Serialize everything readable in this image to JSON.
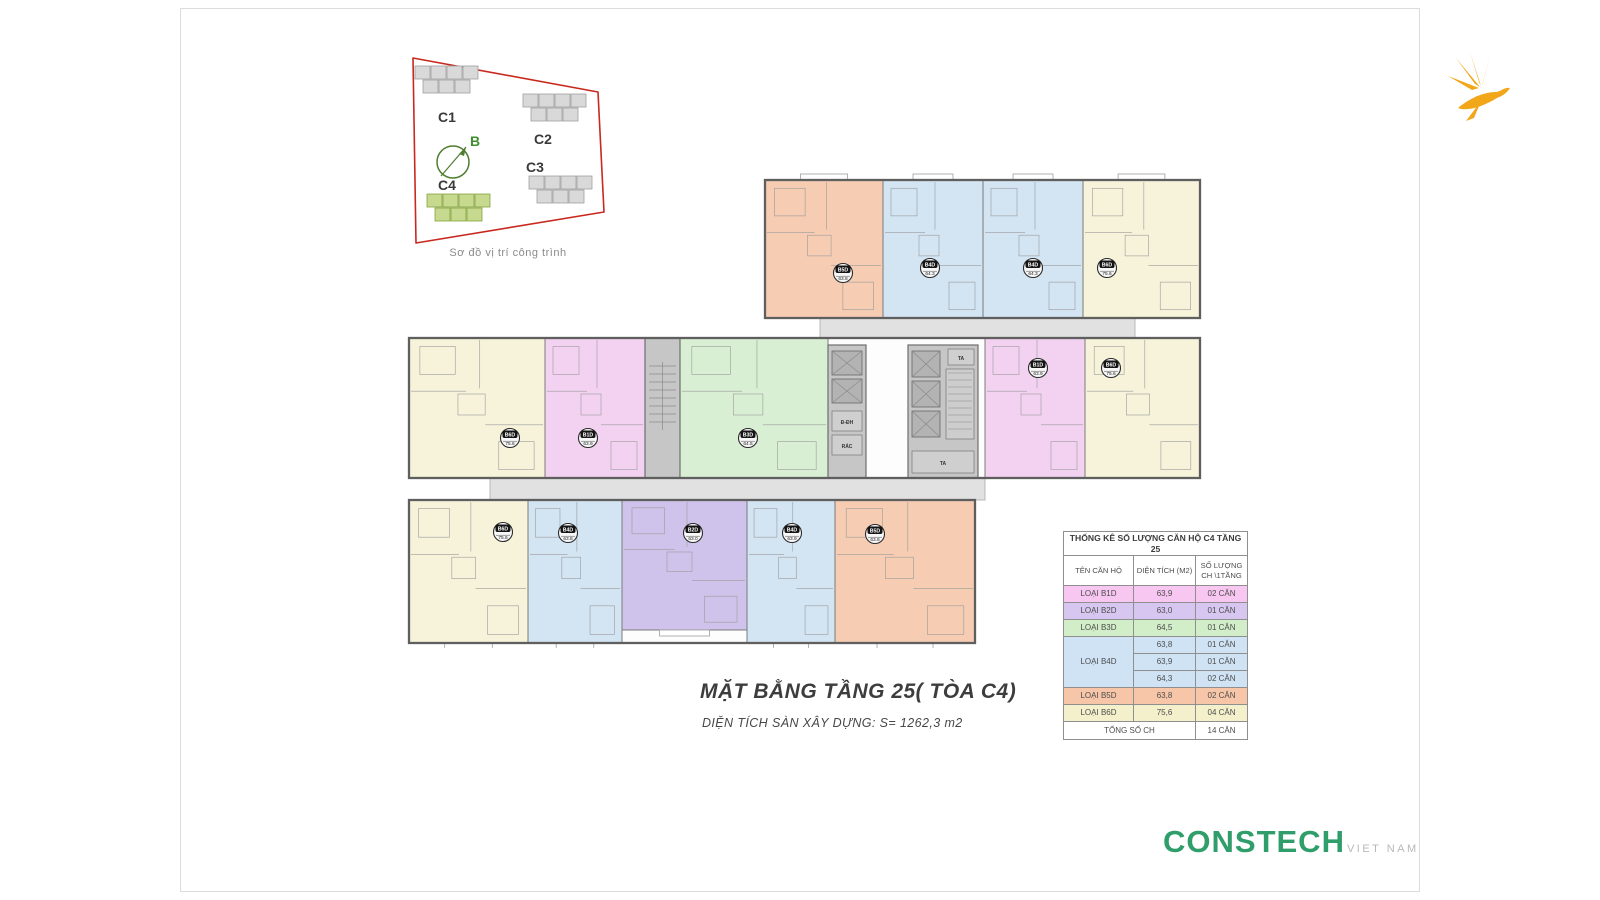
{
  "title_block": {
    "title": "MẶT BẰNG TẦNG 25( TÒA C4)",
    "subtitle": "DIỆN TÍCH SÀN XÂY DỰNG: S= 1262,3 m2"
  },
  "brand": {
    "name": "CONSTECH",
    "suffix": "VIET NAM",
    "color": "#2f9e6a",
    "suffix_color": "#b5bab8"
  },
  "logo_bird": {
    "color": "#f2a71b"
  },
  "site_map": {
    "caption": "Sơ đồ vị trí công trình",
    "north_label": "B",
    "boundary_color": "#c8281e",
    "compass_color": "#4f7d2f",
    "building_color": "#d9d9d9",
    "building_stroke": "#9e9e9e",
    "highlight_color": "#c6d98f",
    "highlight_stroke": "#85a23e",
    "buildings": [
      {
        "label": "C1",
        "x": 25,
        "y": 16,
        "highlight": false,
        "label_x": 48,
        "label_y": 72
      },
      {
        "label": "C2",
        "x": 133,
        "y": 44,
        "highlight": false,
        "label_x": 144,
        "label_y": 94
      },
      {
        "label": "C3",
        "x": 139,
        "y": 126,
        "highlight": false,
        "label_x": 136,
        "label_y": 122
      },
      {
        "label": "C4",
        "x": 37,
        "y": 144,
        "highlight": true,
        "label_x": 48,
        "label_y": 140
      }
    ]
  },
  "floor_plan": {
    "wall_color": "#5f5f5f",
    "line_color": "#9b9b9b",
    "corridor_color": "#e1e1e1",
    "core_color": "#c6c6c6",
    "core_cell_color": "#b3b3b3",
    "core_labels": {
      "lift": "TA",
      "electrical": "Đ-ĐH",
      "trash": "RÁC"
    },
    "wings": [
      {
        "x": 370,
        "y": 12,
        "w": 435,
        "h": 138
      },
      {
        "x": 14,
        "y": 170,
        "w": 791,
        "h": 140
      },
      {
        "x": 14,
        "y": 332,
        "w": 566,
        "h": 143
      }
    ],
    "corridors": [
      {
        "x": 425,
        "y": 150,
        "w": 315,
        "h": 25
      },
      {
        "x": 95,
        "y": 310,
        "w": 495,
        "h": 22
      }
    ],
    "cores": [
      {
        "kind": "stair",
        "x": 250,
        "y": 170,
        "w": 35,
        "h": 140
      },
      {
        "kind": "lift2",
        "x": 433,
        "y": 177,
        "w": 38,
        "h": 133
      },
      {
        "kind": "lift3",
        "x": 513,
        "y": 177,
        "w": 70,
        "h": 133
      }
    ],
    "units": [
      {
        "type": "B5D",
        "area": "63.8",
        "color": "#f6ccb2",
        "x": 370,
        "y": 12,
        "w": 118,
        "h": 138,
        "bx": 448,
        "by": 105
      },
      {
        "type": "B4D",
        "area": "64.3",
        "color": "#d3e4f3",
        "x": 488,
        "y": 12,
        "w": 100,
        "h": 138,
        "bx": 535,
        "by": 100
      },
      {
        "type": "B4D",
        "area": "64.3",
        "color": "#d3e4f3",
        "x": 588,
        "y": 12,
        "w": 100,
        "h": 138,
        "bx": 638,
        "by": 100
      },
      {
        "type": "B6D",
        "area": "75.6",
        "color": "#f6f3da",
        "x": 688,
        "y": 12,
        "w": 117,
        "h": 138,
        "bx": 712,
        "by": 100
      },
      {
        "type": "B6D",
        "area": "75.6",
        "color": "#f6f3da",
        "x": 14,
        "y": 170,
        "w": 136,
        "h": 140,
        "bx": 115,
        "by": 270
      },
      {
        "type": "B1D",
        "area": "63.9",
        "color": "#f3d2f1",
        "x": 150,
        "y": 170,
        "w": 100,
        "h": 140,
        "bx": 193,
        "by": 270
      },
      {
        "type": "B3D",
        "area": "64.5",
        "color": "#d9efd3",
        "x": 285,
        "y": 170,
        "w": 148,
        "h": 140,
        "bx": 353,
        "by": 270
      },
      {
        "type": "B1D",
        "area": "63.9",
        "color": "#f3d2f1",
        "x": 590,
        "y": 170,
        "w": 100,
        "h": 140,
        "bx": 643,
        "by": 200
      },
      {
        "type": "B6D",
        "area": "75.6",
        "color": "#f6f3da",
        "x": 690,
        "y": 170,
        "w": 115,
        "h": 140,
        "bx": 716,
        "by": 200
      },
      {
        "type": "B6D",
        "area": "75.6",
        "color": "#f6f3da",
        "x": 14,
        "y": 332,
        "w": 119,
        "h": 143,
        "bx": 108,
        "by": 364
      },
      {
        "type": "B4D",
        "area": "63.8",
        "color": "#d3e4f3",
        "x": 133,
        "y": 332,
        "w": 94,
        "h": 143,
        "bx": 173,
        "by": 365
      },
      {
        "type": "B2D",
        "area": "63.0",
        "color": "#cfc3eb",
        "x": 227,
        "y": 332,
        "w": 125,
        "h": 130,
        "bx": 298,
        "by": 365
      },
      {
        "type": "B4D",
        "area": "63.9",
        "color": "#d3e4f3",
        "x": 352,
        "y": 332,
        "w": 88,
        "h": 143,
        "bx": 397,
        "by": 365
      },
      {
        "type": "B5D",
        "area": "63.8",
        "color": "#f6ccb2",
        "x": 440,
        "y": 332,
        "w": 140,
        "h": 143,
        "bx": 480,
        "by": 366
      }
    ]
  },
  "stats_table": {
    "title": "THỐNG KÊ SỐ LƯỢNG CĂN HỘ C4 TẦNG 25",
    "columns": [
      "TÊN CĂN HỘ",
      "DIỆN TÍCH (M2)",
      "SỐ LƯỢNG CH \\1TẦNG"
    ],
    "rows": [
      {
        "label": "LOẠI B1D",
        "area": "63,9",
        "count": "02 CĂN",
        "color": "#f7c6f1",
        "span": 1
      },
      {
        "label": "LOẠI B2D",
        "area": "63,0",
        "count": "01 CĂN",
        "color": "#d6c6f0",
        "span": 1
      },
      {
        "label": "LOẠI B3D",
        "area": "64,5",
        "count": "01 CĂN",
        "color": "#d2eec8",
        "span": 1
      },
      {
        "label": "LOẠI B4D",
        "area": "63,8",
        "count": "01 CĂN",
        "color": "#cfe3f5",
        "span": 3
      },
      {
        "label": null,
        "area": "63,9",
        "count": "01 CĂN",
        "color": "#cfe3f5"
      },
      {
        "label": null,
        "area": "64,3",
        "count": "02 CĂN",
        "color": "#cfe3f5"
      },
      {
        "label": "LOẠI B5D",
        "area": "63,8",
        "count": "02 CĂN",
        "color": "#f7c6a8",
        "span": 1
      },
      {
        "label": "LOẠI B6D",
        "area": "75,6",
        "count": "04 CĂN",
        "color": "#f3f0cb",
        "span": 1
      }
    ],
    "total_label": "TỔNG SỐ CH",
    "total_count": "14 CĂN"
  }
}
